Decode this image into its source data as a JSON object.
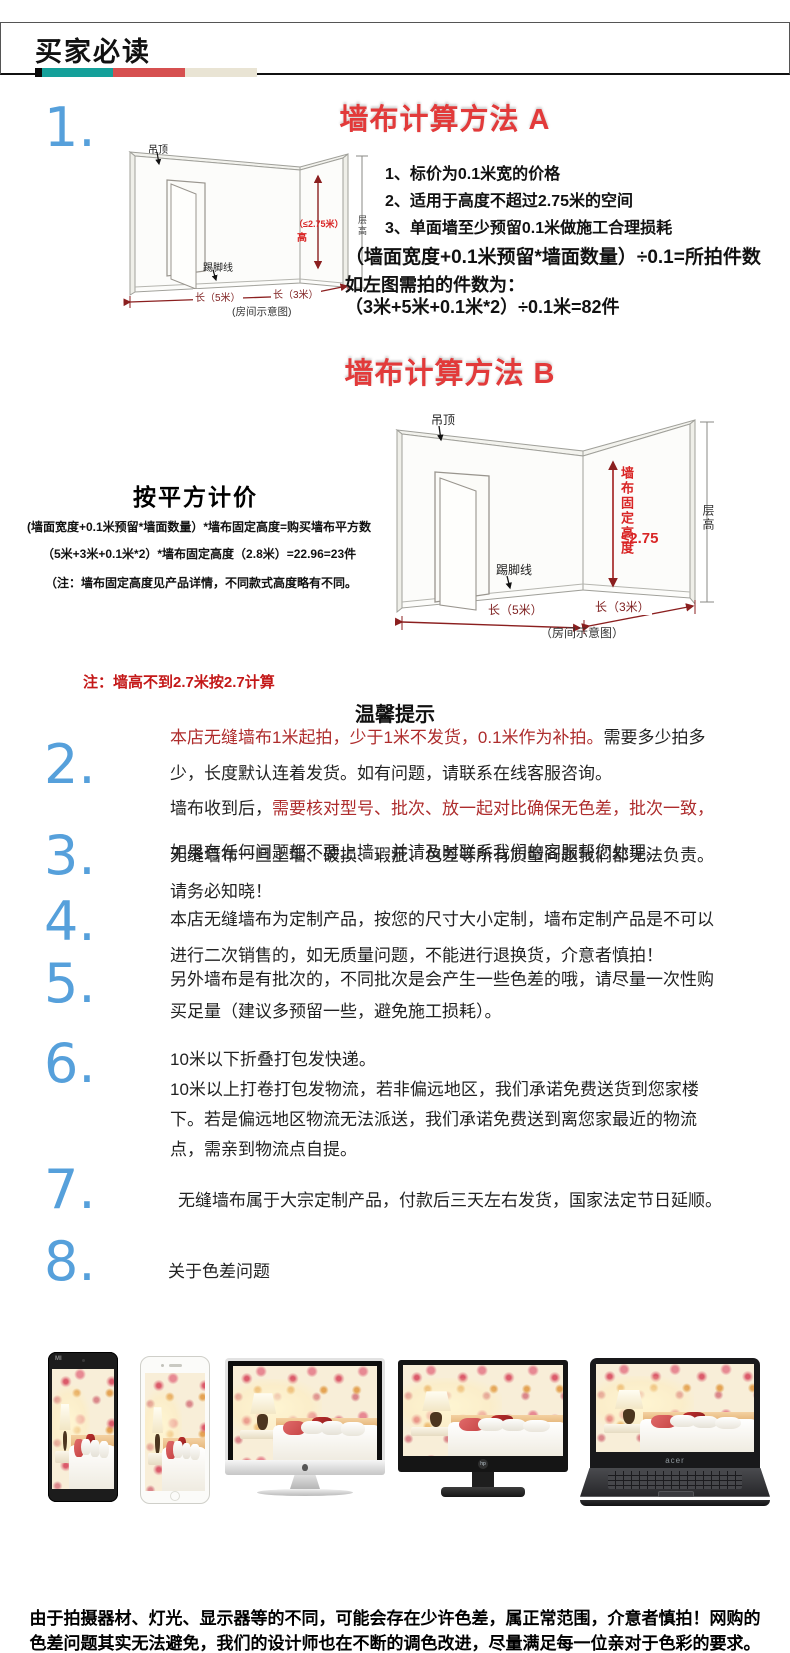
{
  "header": {
    "title": "买家必读"
  },
  "colors": {
    "accent_blue": "#56a0db",
    "title_red": "#e23a3a",
    "note_red": "#c41818",
    "body_red": "#ae2c2c",
    "teal_bar": "#14a09a",
    "red_bar": "#d65050",
    "beige_bar": "#e9e4d4"
  },
  "section_a": {
    "number": "1.",
    "title": "墙布计算方法 A",
    "rules": [
      "1、标价为0.1米宽的价格",
      "2、适用于高度不超过2.75米的空间",
      "3、单面墙至少预留0.1米做施工合理损耗"
    ],
    "formula": "（墙面宽度+0.1米预留*墙面数量）÷0.1=所拍件数",
    "example_intro": "如左图需拍的件数为：",
    "example": "（3米+5米+0.1米*2）÷0.1米=82件",
    "diagram": {
      "ceiling": "吊顶",
      "baseboard": "踢脚线",
      "height_note": "（≤2.75米）",
      "height_word": "高",
      "floor_height": "层高",
      "len5": "长（5米）",
      "len3": "长（3米）",
      "caption": "(房间示意图)"
    }
  },
  "section_b": {
    "title": "墙布计算方法 B",
    "subtitle": "按平方计价",
    "formula": "(墙面宽度+0.1米预留*墙面数量）*墙布固定高度=购买墙布平方数",
    "example": "（5米+3米+0.1米*2）*墙布固定高度（2.8米）=22.96=23件",
    "note": "（注：墙布固定高度见产品详情，不同款式高度略有不同。",
    "diagram": {
      "ceiling": "吊顶",
      "baseboard": "踢脚线",
      "fixed_height": "墙布固定高度",
      "height_value": "≤2.75",
      "floor_height": "层高",
      "len5": "长（5米）",
      "len3": "长（3米）",
      "caption": "（房间示意图）"
    }
  },
  "wall_note": "注：墙高不到2.7米按2.7计算",
  "tips_title": "温馨提示",
  "tips": [
    {
      "number": "2.",
      "lines": [
        [
          {
            "text": "本店无缝墙布1米起拍，少于1米不发货，0.1米作为补拍。",
            "color": "red"
          },
          {
            "text": "需要多少拍多",
            "color": "black"
          }
        ],
        [
          {
            "text": "少，长度默认连着发货。如有问题，请联系在线客服咨询。",
            "color": "black"
          }
        ],
        [
          {
            "text": "墙布收到后，",
            "color": "black"
          },
          {
            "text": "需要核对型号、批次、放一起对比确保无色差，批次一致，",
            "color": "red"
          }
        ],
        [
          {
            "text": "如果有任何问题都不要上墙，并请及时联系我们的客服帮您处理。",
            "color": "black"
          }
        ]
      ]
    },
    {
      "number": "3.",
      "lines": [
        [
          {
            "text": "无缝墙布一旦上墙、破损、瑕疵、色差等所有质量问题我们都无法负责。",
            "color": "black"
          }
        ],
        [
          {
            "text": "请务必知晓！",
            "color": "black"
          }
        ]
      ]
    },
    {
      "number": "4.",
      "lines": [
        [
          {
            "text": "本店无缝墙布为定制产品，按您的尺寸大小定制，墙布定制产品是不可以",
            "color": "black"
          }
        ],
        [
          {
            "text": "进行二次销售的，如无质量问题，不能进行退换货，介意者慎拍！",
            "color": "black"
          }
        ]
      ]
    },
    {
      "number": "5.",
      "lines": [
        [
          {
            "text": "另外墙布是有批次的，不同批次是会产生一些色差的哦，请尽量一次性购",
            "color": "black"
          }
        ],
        [
          {
            "text": "买足量（建议多预留一些，避免施工损耗）。",
            "color": "black"
          }
        ]
      ]
    },
    {
      "number": "6.",
      "lines": [
        [
          {
            "text": "10米以下折叠打包发快递。",
            "color": "black"
          }
        ],
        [
          {
            "text": "10米以上打卷打包发物流，若非偏远地区，我们承诺免费送货到您家楼",
            "color": "black"
          }
        ],
        [
          {
            "text": "下。若是偏远地区物流无法派送，我们承诺免费送到离您家最近的物流",
            "color": "black"
          }
        ],
        [
          {
            "text": "点，需亲到物流点自提。",
            "color": "black"
          }
        ]
      ]
    },
    {
      "number": "7.",
      "lines": [
        [
          {
            "text": "无缝墙布属于大宗定制产品，付款后三天左右发货，国家法定节日延顺。",
            "color": "black"
          }
        ]
      ]
    },
    {
      "number": "8.",
      "lines": [
        [
          {
            "text": "关于色差问题",
            "color": "black"
          }
        ]
      ]
    }
  ],
  "devices": {
    "tablet_logo": "MI",
    "monitor_logo": "hp",
    "laptop_logo": "acer"
  },
  "footer": {
    "line1": "由于拍摄器材、灯光、显示器等的不同，可能会存在少许色差，属正常范围，介意者慎拍！网购的",
    "line2": "色差问题其实无法避免，我们的设计师也在不断的调色改进，尽量满足每一位亲对于色彩的要求。"
  }
}
